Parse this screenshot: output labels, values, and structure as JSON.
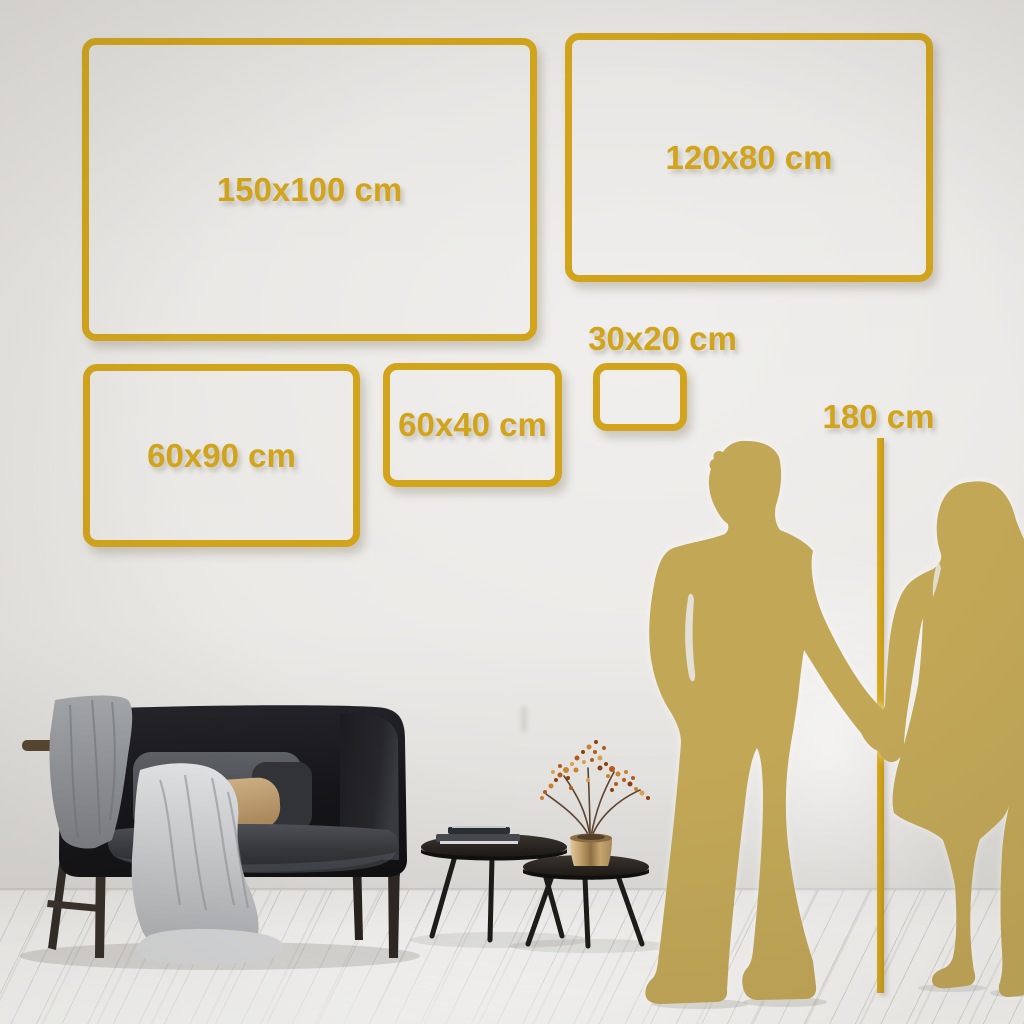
{
  "size_labels": {
    "s150x100": "150x100 cm",
    "s120x80": "120x80 cm",
    "s60x90": "60x90 cm",
    "s60x40": "60x40 cm",
    "s30x20": "30x20 cm"
  },
  "height_marker": {
    "label": "180 cm"
  },
  "colors": {
    "gold": "#D1A41C",
    "silhouette": "#C2A756",
    "wall": "#E7E5E2",
    "floor": "#F3F2F0"
  }
}
